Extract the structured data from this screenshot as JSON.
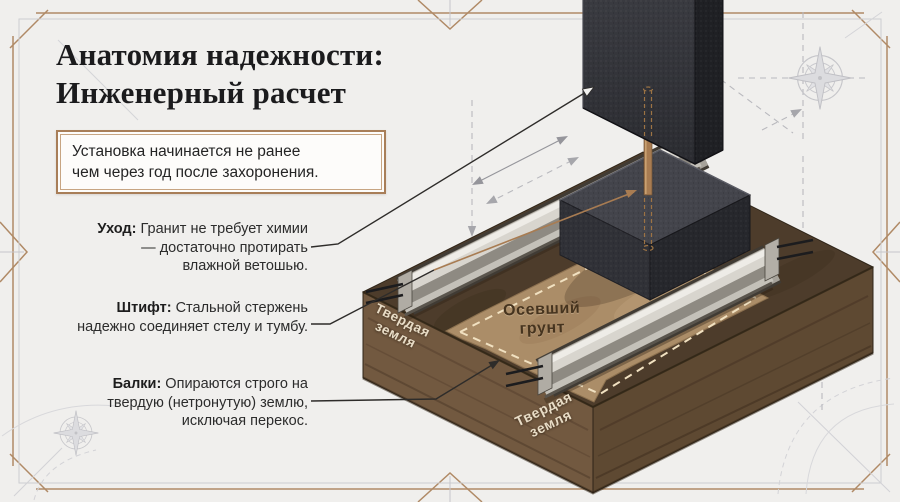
{
  "page": {
    "title_line1": "Анатомия надежности:",
    "title_line2": "Инженерный расчет"
  },
  "notice": {
    "line1": "Установка начинается не ранее",
    "line2": "чем через год после захоронения."
  },
  "annotations": [
    {
      "label": "Уход:",
      "text": " Гранит не требует химии — достаточно протирать влажной ветошью."
    },
    {
      "label": "Штифт:",
      "text": " Стальной стержень надежно соединяет стелу и тумбу."
    },
    {
      "label": "Балки:",
      "text": " Опираются строго на твердую (нетронутую) землю, исключая перекос."
    }
  ],
  "diagram_labels": {
    "hard_ground_left": "Твердая земля",
    "hard_ground_front": "Твердая земля",
    "settled_soil": "Осевший грунт"
  },
  "colors": {
    "background": "#f0efed",
    "accent": "#a87e58",
    "title": "#1b1b1d",
    "text": "#242424",
    "cream": "#e8dcc6",
    "settled": "#46341f",
    "frame_bronze": "#b08a66",
    "frame_gray": "#cdced1",
    "granite_front": "#34353b",
    "granite_side": "#1f2024",
    "pin_bronze": "#a87c52",
    "concrete": "#a6a29a",
    "soil_top": "#4d3c2b",
    "soil_left": "#725940",
    "soil_right": "#5e4932",
    "settled_soil_fill": "#ab8d68"
  }
}
